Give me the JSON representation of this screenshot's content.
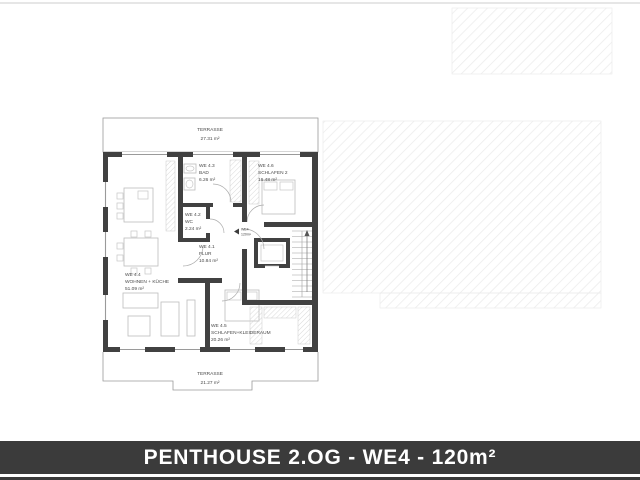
{
  "page": {
    "background": "#ffffff"
  },
  "plan": {
    "terraces": [
      {
        "name": "TERRASSE",
        "area": "27.31 m²",
        "position": "top"
      },
      {
        "name": "TERRASSE",
        "area": "21.27 m²",
        "position": "bottom"
      }
    ],
    "rooms": [
      {
        "id": "WE 4.1",
        "name": "FLUR",
        "area": "10.84 m²"
      },
      {
        "id": "WE 4.2",
        "name": "WC",
        "area": "2.24 m²"
      },
      {
        "id": "WE 4.3",
        "name": "BAD",
        "area": "6.26 m²"
      },
      {
        "id": "WE 4.4",
        "name": "WOHNEN + KÜCHE",
        "area": "51.09 m²"
      },
      {
        "id": "WE 4.5",
        "name": "SCHLAFEN+KLEIDERAUM",
        "area": "20.26 m²"
      },
      {
        "id": "WE 4.6",
        "name": "SCHLAFEN 2",
        "area": "16.48 m²"
      }
    ],
    "unit_marker": {
      "id": "WE4",
      "area": "120m²"
    }
  },
  "title_bar": {
    "text": "PENTHOUSE 2.OG - WE4 - 120m²"
  },
  "colors": {
    "wall": "#414141",
    "title_bar_bg": "#3b3b3b",
    "title_text": "#ffffff",
    "outline": "#9a9a9a",
    "hatch_line": "#e9e9e9",
    "furniture_line": "#bdbdbd"
  }
}
